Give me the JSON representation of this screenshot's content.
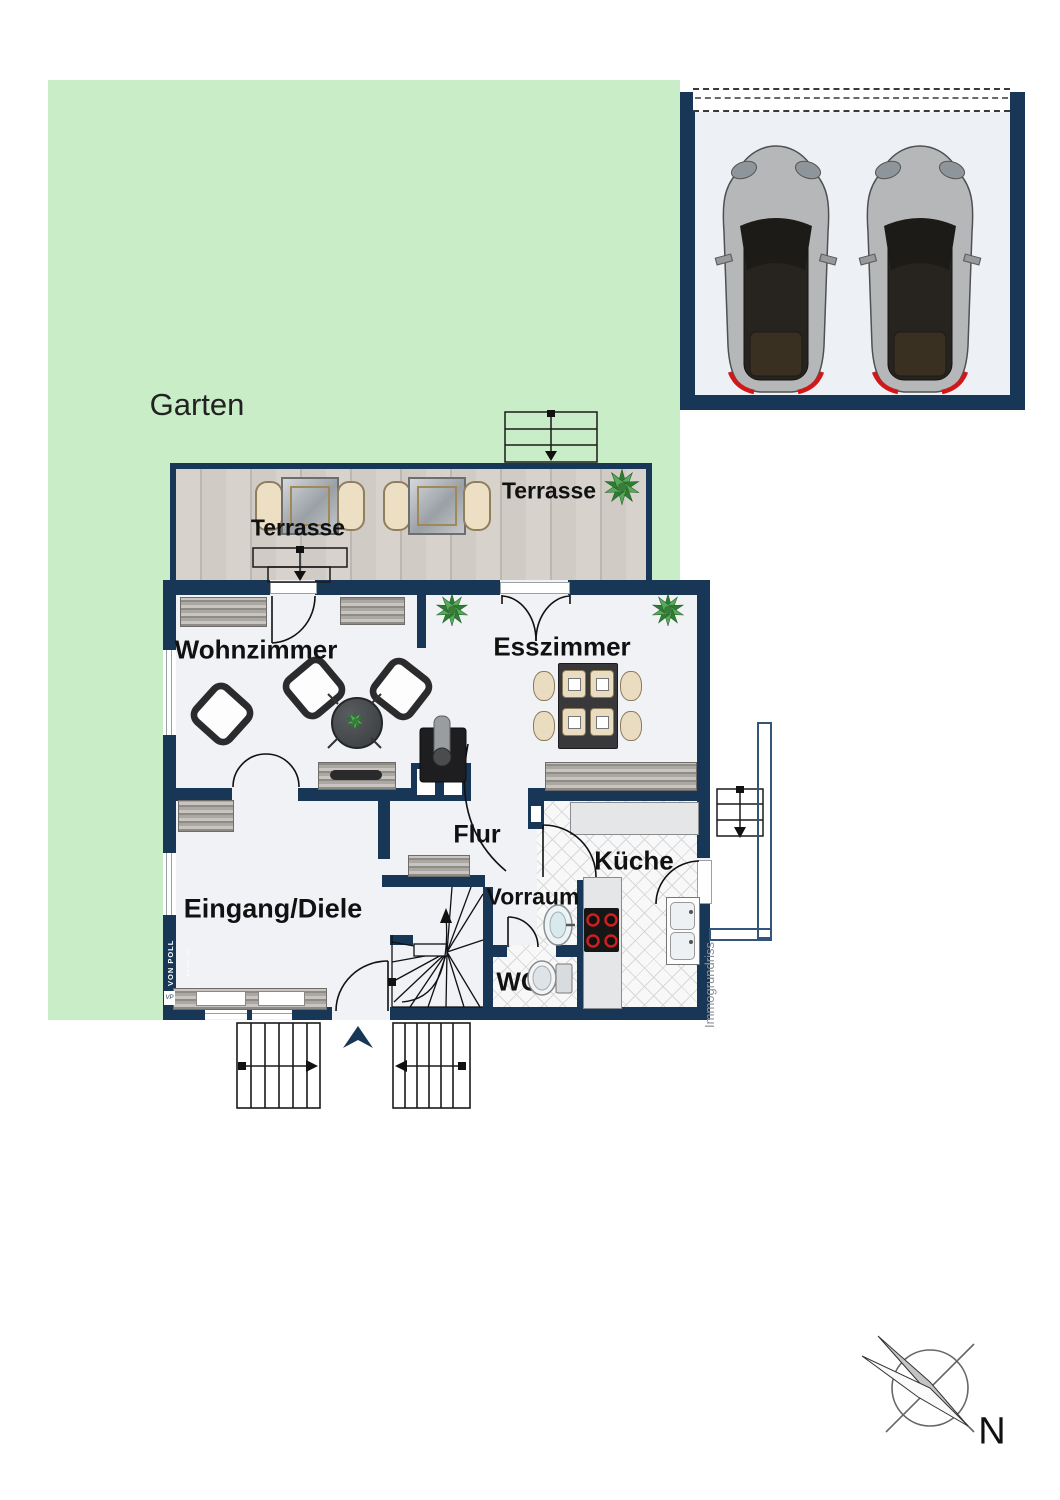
{
  "plan": {
    "garden": {
      "label": "Garten"
    },
    "terraces": [
      {
        "label": "Terrasse"
      },
      {
        "label": "Terrasse"
      }
    ],
    "rooms": {
      "wohnzimmer": {
        "label": "Wohnzimmer"
      },
      "esszimmer": {
        "label": "Esszimmer"
      },
      "flur": {
        "label": "Flur"
      },
      "kueche": {
        "label": "Küche"
      },
      "eingang_diele": {
        "label": "Eingang/Diele"
      },
      "vorraum": {
        "label": "Vorraum"
      },
      "wc": {
        "label": "WC"
      }
    }
  },
  "branding": {
    "logo_text": "VON POLL",
    "logo_subtext": "IMMOBILIEN",
    "logo_monogram": "VP",
    "watermark": "Immogrundriss"
  },
  "compass": {
    "north_label": "N"
  },
  "colors": {
    "wall_navy": "#183655",
    "garden_green": "#c9eec7",
    "floor_gray": "#f0f2f6",
    "terrace_wood": "#d7d1cc",
    "burner_red": "#cc2020"
  }
}
